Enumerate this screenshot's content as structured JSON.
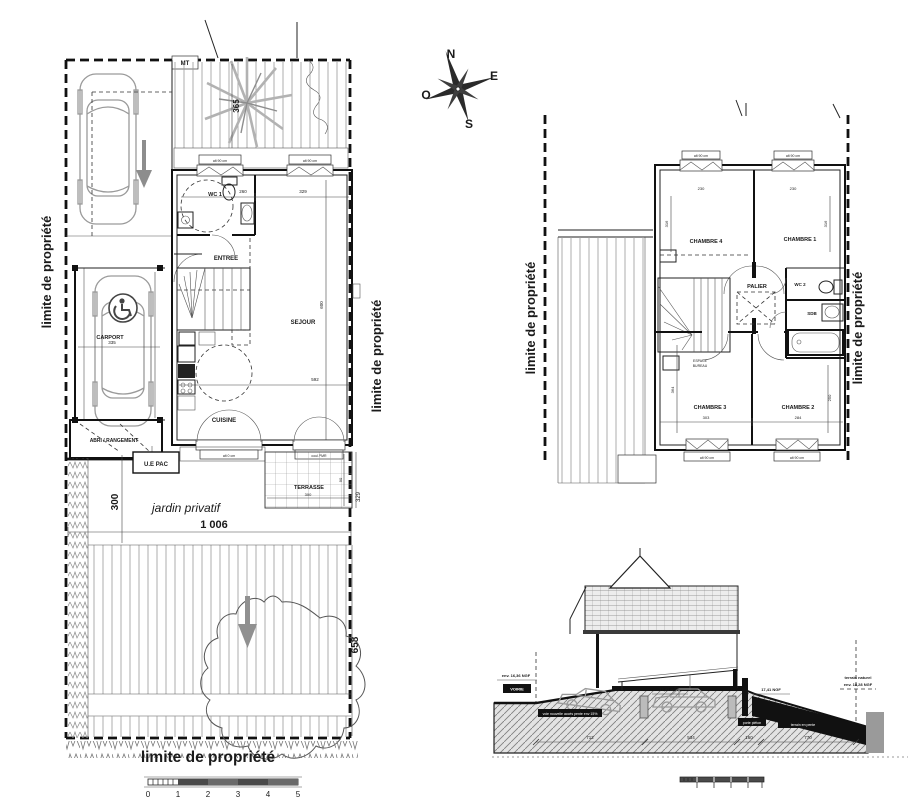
{
  "site_plan": {
    "boundary": "limite de propriété",
    "jardin": "jardin privatif",
    "marker": "MT",
    "rooms": {
      "wc1": "WC 1",
      "entree": "ENTREE",
      "sejour": "SEJOUR",
      "cuisine": "CUISINE",
      "carport": "CARPORT",
      "abri": "ABRI / RANGEMENT",
      "uepac": "U.E PAC",
      "terrasse": "TERRASSE"
    },
    "dims": {
      "driveway_depth": "365",
      "wc_width": "260",
      "sejour_top": "329",
      "sejour_height": "600",
      "sejour_width": "592",
      "carport_width": "335",
      "terrasse_width": "300",
      "terrasse_depth": "90",
      "terrasse_side": "329",
      "garden_offset": "300",
      "plot_width": "1 006",
      "garden_depth": "658"
    },
    "window_label": "alt 90 cm",
    "door_label_1": "alt 0 cm",
    "door_label_2": "coul.PMR",
    "scale": [
      "0",
      "1",
      "2",
      "3",
      "4",
      "5"
    ]
  },
  "compass": {
    "n": "N",
    "e": "E",
    "s": "S",
    "o": "O"
  },
  "floor_plan": {
    "boundary": "limite de propriété",
    "rooms": {
      "chambre1": "CHAMBRE 1",
      "chambre2": "CHAMBRE 2",
      "chambre3": "CHAMBRE 3",
      "chambre4": "CHAMBRE 4",
      "palier": "PALIER",
      "wc2": "WC 2",
      "sdb": "SDB",
      "bureau1": "ESPACE",
      "bureau2": "BUREAU"
    },
    "dims": {
      "ch4_h": "316",
      "ch1_h": "316",
      "win_l": "230",
      "win_r": "230",
      "ch3_h": "364",
      "ch2_h": "250",
      "ch3_w": "303",
      "ch2_w": "284"
    },
    "window_label": "alt 90 cm"
  },
  "section": {
    "levels": {
      "street": "env. 16,36 NGF",
      "floor1": "17,41 NGF",
      "floor2": "17,41 NGF",
      "natural1": "terrain naturel",
      "natural2": "env. 18,28 NGF"
    },
    "boxes": {
      "voirie": "VOIRIE",
      "ramp": "voie nouvelle accès pente env 15%",
      "porte": "porte piéton",
      "pente": "terrain en pente"
    },
    "dims": [
      "712",
      "534",
      "160",
      "770"
    ]
  }
}
